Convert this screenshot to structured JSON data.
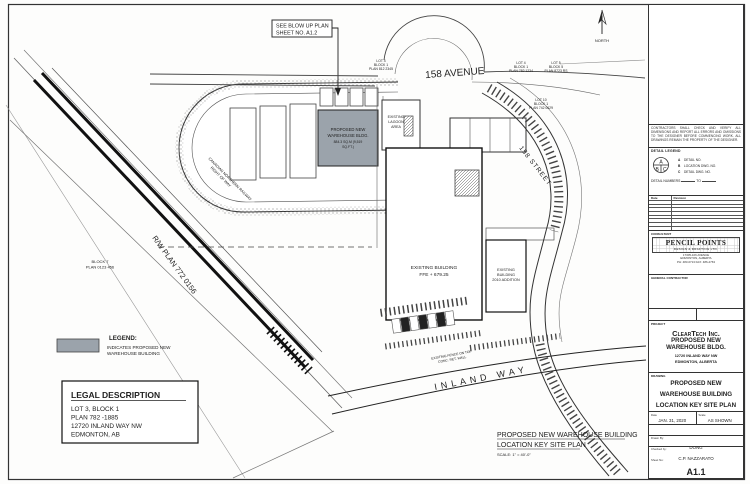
{
  "colors": {
    "ink": "#222222",
    "paper": "#ffffff",
    "proposed_gray": "#9ba3ab"
  },
  "callout": {
    "line1": "SEE BLOW UP PLAN",
    "line2": "SHEET NO. A1.2"
  },
  "north": {
    "label": "NORTH"
  },
  "roads": {
    "avenue": "158 AVENUE",
    "street": "158 STREET",
    "inland_way": "INLAND WAY"
  },
  "annotations": {
    "rw_plan": "R/W PLAN 772 0156",
    "railway_line1": "CANADIAN NORTHERN RAILWAY",
    "railway_line2": "RIGHT OF WAY",
    "block7_line1": "BLOCK 7",
    "block7_line2": "PLAN 0123 456",
    "lot_a_line1": "LOT 4",
    "lot_a_line2": "BLOCK 1",
    "lot_a_line3": "PLAN 812 2345",
    "lot_b_line1": "LOT 4",
    "lot_b_line2": "BLOCK 1",
    "lot_b_line3": "PLAN 782 1234",
    "lot_c_line1": "LOT 5",
    "lot_c_line2": "BLOCK 5",
    "lot_c_line3": "PLAN 8723 RS",
    "lot_d_line1": "LOT 10",
    "lot_d_line2": "BLOCK 1",
    "lot_d_line3": "PLAN 742 0629",
    "fence_line1": "EXISTING FENCE ON TOP",
    "fence_line2": "CONC. RET. WALL"
  },
  "buildings": {
    "proposed": {
      "line1": "PROPOSED NEW",
      "line2": "WAREHOUSE BLDG.",
      "line3": "884.3 SQ.M (9,519",
      "line4": "SQ.FT.)"
    },
    "existing_main": {
      "line1": "EXISTING BUILDING",
      "line2": "FFE + 679.25"
    },
    "addition": {
      "line1": "EXISTING",
      "line2": "BUILDING",
      "line3": "2010 ADDITION"
    },
    "lagoon": {
      "line1": "EXISTING",
      "line2": "LAGOON",
      "line3": "AREA"
    }
  },
  "legend": {
    "title": "LEGEND:",
    "line1": "INDICATES PROPOSED NEW",
    "line2": "WAREHOUSE BUILDING"
  },
  "legal": {
    "title": "LEGAL DESCRIPTION",
    "line1": "LOT 3, BLOCK 1",
    "line2": "PLAN 782 -1885",
    "line3": "12720 INLAND WAY NW",
    "line4": "EDMONTON, AB"
  },
  "plan_title": {
    "line1": "PROPOSED NEW WAREHOUSE BUILDING",
    "line2": "LOCATION KEY SITE PLAN",
    "scale": "SCALE: 1\" = 40'-0\""
  },
  "titleblock": {
    "notes": "CONTRACTORS SHALL CHECK AND VERIFY ALL DIMENSIONS AND REPORT ALL ERRORS AND OMISSIONS TO THE DESIGNER BEFORE COMMENCING WORK. ALL DRAWINGS REMAIN THE PROPERTY OF THE DESIGNER.",
    "detail": {
      "title": "DETAIL LEGEND",
      "a": "A",
      "b": "B",
      "c": "C",
      "item_a": "DETAIL NO.",
      "item_b": "LOCATION DWG. NO.",
      "item_c": "DETAIL DWG. NO.",
      "numbers_label": "DETAIL NUMBERS",
      "to": "TO"
    },
    "revisions": {
      "date_header": "Date",
      "revision_header": "Revision"
    },
    "consultant": {
      "label": "CONSULTANT",
      "name": "PENCIL POINTS",
      "sub": "DESIGN & DRAFTING LTD.",
      "addr1": "17305-106 AVENUE",
      "addr2": "EDMONTON, ALBERTA",
      "addr3": "PH: 483-0713   FAX: 486-4763"
    },
    "gc_label": "GENERAL CONTRACTOR",
    "project": {
      "label": "PROJECT",
      "client": "ClearTech Inc.",
      "line1": "PROPOSED NEW",
      "line2": "WAREHOUSE BLDG.",
      "line3": "12720 INLAND WAY NW",
      "line4": "EDMONTON, ALBERTA"
    },
    "drawing": {
      "label": "DRAWING",
      "line1": "PROPOSED NEW",
      "line2": "WAREHOUSE BUILDING",
      "line3": "LOCATION KEY SITE PLAN"
    },
    "date": {
      "label": "Date",
      "value": "JAN. 31, 2020"
    },
    "scale": {
      "label": "Scale",
      "value": "AS SHOWN"
    },
    "drawn": {
      "label": "Drawn By:",
      "value": "DONG"
    },
    "checked": {
      "label": "Checked by:",
      "value": "C.P. NAZZARATO"
    },
    "sheet": {
      "label": "Sheet No:",
      "value": "A1.1"
    }
  }
}
